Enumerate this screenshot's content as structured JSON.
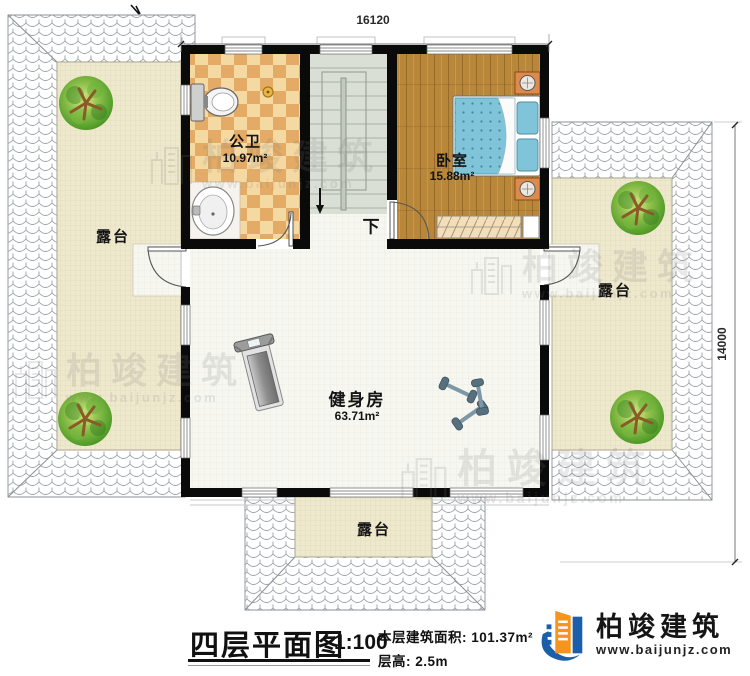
{
  "meta": {
    "kind": "architectural floor plan, fourth floor"
  },
  "dimensions": {
    "top_width": "16120",
    "right_height": "14000"
  },
  "rooms": {
    "bathroom": {
      "name": "公卫",
      "area": "10.97m²"
    },
    "bedroom": {
      "name": "卧室",
      "area": "15.88m²"
    },
    "gym": {
      "name": "健身房",
      "area": "63.71m²"
    },
    "terrace_left": {
      "name": "露台"
    },
    "terrace_right": {
      "name": "露台"
    },
    "terrace_bottom": {
      "name": "露台"
    },
    "stairs": {
      "down_label": "下"
    }
  },
  "title_block": {
    "title": "四层平面图",
    "scale": "1:100",
    "floor_area_label": "本层建筑面积:",
    "floor_area_value": "101.37m²",
    "floor_height_label": "层高:",
    "floor_height_value": "2.5m"
  },
  "logo": {
    "company": "柏竣建筑",
    "website": "www.baijunjz.com"
  },
  "watermark": {
    "text": "柏竣建筑",
    "website": "www.baijunjz.com"
  },
  "icons": {
    "tree-icon": "round garden tree, top view",
    "toilet-icon": "toilet, top view",
    "sink-icon": "wash basin, top view",
    "bed-icon": "double bed with blue dotted cover",
    "wardrobe-icon": "wardrobe with hanger hatch",
    "treadmill-icon": "treadmill, top view",
    "dumbbells-icon": "dumbbell set, top view",
    "stairs-down-arrow-icon": "downward stair direction arrow",
    "company-logo-icon": "blue and orange building mark",
    "watermark-building-icon": "outlined buildings mark"
  },
  "colors": {
    "wall": "#0a0a0a",
    "wood_floor": "#b9873a",
    "bathroom_tile_light": "#f5d9a2",
    "bathroom_tile_dark": "#e3ab66",
    "stair_floor": "#d9dfd4",
    "terrace_floor": "#eee8cd",
    "gym_floor": "#f7f7f2",
    "bed_blue": "#7fc4d8",
    "tree_green": "#5aa233",
    "logo_blue": "#1b5ea9",
    "logo_orange": "#f7941d"
  }
}
